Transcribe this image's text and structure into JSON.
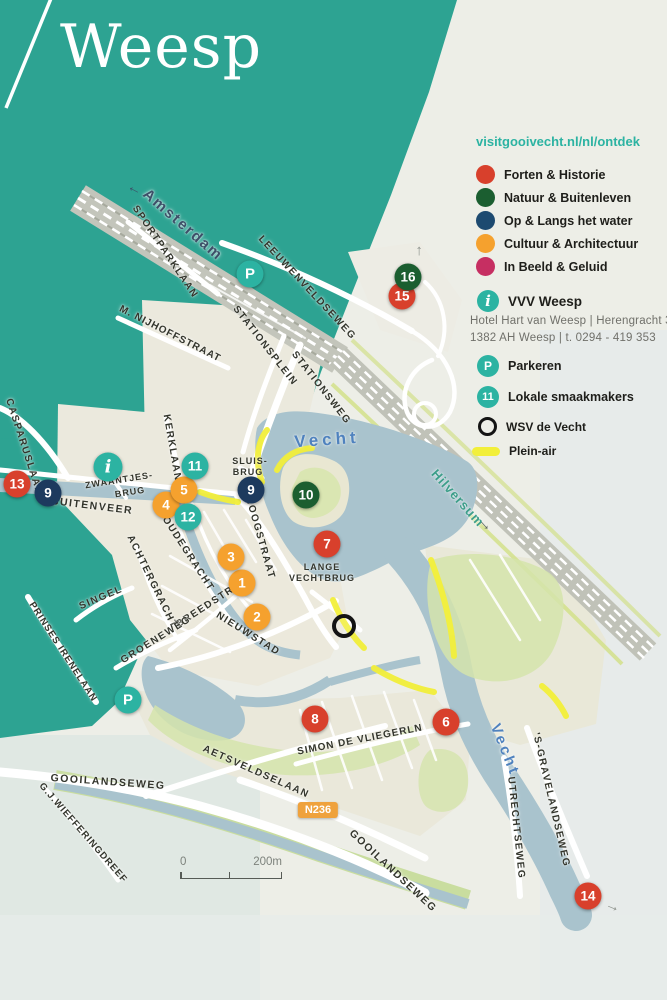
{
  "header": {
    "title": "Weesp"
  },
  "legend": {
    "url": "visitgooivecht.nl/nl/ontdek",
    "categories": [
      {
        "label": "Forten & Historie",
        "color": "#d8402c"
      },
      {
        "label": "Natuur & Buitenleven",
        "color": "#1b5e30"
      },
      {
        "label": "Op & Langs het water",
        "color": "#1d4a70"
      },
      {
        "label": "Cultuur & Architectuur",
        "color": "#f5a12e"
      },
      {
        "label": "In Beeld & Geluid",
        "color": "#c62f62"
      }
    ],
    "vvv": {
      "icon": "i",
      "name": "VVV Weesp",
      "address_line1": "Hotel Hart van Weesp | Herengracht 35 |",
      "address_line2": "1382 AH Weesp | t. 0294 - 419 353"
    },
    "parking": {
      "icon": "P",
      "label": "Parkeren"
    },
    "local": {
      "icon": "11",
      "label": "Lokale smaakmakers"
    },
    "wsv": {
      "label": "WSV de Vecht"
    },
    "plein_air": {
      "label": "Plein-air"
    }
  },
  "map": {
    "road_badge": "N236",
    "scale_bar": {
      "start": "0",
      "end": "200m"
    },
    "markers": [
      {
        "n": "1",
        "c": "orange",
        "x": 242,
        "y": 583
      },
      {
        "n": "2",
        "c": "orange",
        "x": 257,
        "y": 617
      },
      {
        "n": "3",
        "c": "orange",
        "x": 231,
        "y": 557
      },
      {
        "n": "4",
        "c": "orange",
        "x": 166,
        "y": 505
      },
      {
        "n": "5",
        "c": "orange",
        "x": 184,
        "y": 490
      },
      {
        "n": "6",
        "c": "red",
        "x": 446,
        "y": 722
      },
      {
        "n": "7",
        "c": "red",
        "x": 327,
        "y": 544
      },
      {
        "n": "8",
        "c": "red",
        "x": 315,
        "y": 719
      },
      {
        "n": "9",
        "c": "navy",
        "x": 48,
        "y": 493
      },
      {
        "n": "9",
        "c": "navy",
        "x": 251,
        "y": 490
      },
      {
        "n": "10",
        "c": "green",
        "x": 306,
        "y": 495
      },
      {
        "n": "11",
        "c": "teal",
        "x": 195,
        "y": 466
      },
      {
        "n": "12",
        "c": "teal",
        "x": 188,
        "y": 517
      },
      {
        "n": "13",
        "c": "red",
        "x": 17,
        "y": 484
      },
      {
        "n": "14",
        "c": "red",
        "x": 588,
        "y": 896
      },
      {
        "n": "15",
        "c": "red",
        "x": 402,
        "y": 296
      },
      {
        "n": "16",
        "c": "green",
        "x": 408,
        "y": 277
      },
      {
        "n": "i",
        "c": "teal",
        "x": 108,
        "y": 467,
        "k": "info"
      },
      {
        "n": "P",
        "c": "teal",
        "x": 250,
        "y": 274,
        "k": "parking"
      },
      {
        "n": "P",
        "c": "teal",
        "x": 128,
        "y": 700,
        "k": "parking"
      },
      {
        "n": "",
        "c": "ring",
        "x": 344,
        "y": 626,
        "k": "wsv"
      }
    ],
    "labels": [
      {
        "t": "Amsterdam",
        "x": 183,
        "y": 225,
        "r": 41,
        "s": 15,
        "ls": 2,
        "c": "ams"
      },
      {
        "t": "SPORTPARKLAAN",
        "x": 165,
        "y": 252,
        "r": 56,
        "s": 10,
        "ls": 1.5,
        "c": "st"
      },
      {
        "t": "LEEUWENVELDSEWEG",
        "x": 307,
        "y": 288,
        "r": 47,
        "s": 10,
        "ls": 1.5,
        "c": "st"
      },
      {
        "t": "M. NIJHOFFSTRAAT",
        "x": 170,
        "y": 334,
        "r": 27,
        "s": 10,
        "ls": 1,
        "c": "st"
      },
      {
        "t": "STATIONSPLEIN",
        "x": 265,
        "y": 346,
        "r": 52,
        "s": 10,
        "ls": 1.5,
        "c": "st"
      },
      {
        "t": "STATIONSWEG",
        "x": 321,
        "y": 388,
        "r": 52,
        "s": 10,
        "ls": 1.5,
        "c": "st"
      },
      {
        "t": "KERKLAAN",
        "x": 172,
        "y": 448,
        "r": 80,
        "s": 10,
        "ls": 1.5,
        "c": "st"
      },
      {
        "t": "CASPARUSLAAN",
        "x": 24,
        "y": 447,
        "r": 72,
        "s": 10,
        "ls": 1.5,
        "c": "st"
      },
      {
        "t": "ZWAANTJES-",
        "x": 119,
        "y": 480,
        "r": -9,
        "s": 9,
        "ls": 1,
        "c": "st"
      },
      {
        "t": "BRUG",
        "x": 130,
        "y": 492,
        "r": -9,
        "s": 9,
        "ls": 1,
        "c": "st"
      },
      {
        "t": "BUITENVEER",
        "x": 92,
        "y": 506,
        "r": 7,
        "s": 10.5,
        "ls": 1.5,
        "c": "st"
      },
      {
        "t": "SLUIS-",
        "x": 250,
        "y": 461,
        "r": 0,
        "s": 9,
        "ls": 1,
        "c": "st"
      },
      {
        "t": "BRUG",
        "x": 248,
        "y": 472,
        "r": 0,
        "s": 9,
        "ls": 1,
        "c": "st"
      },
      {
        "t": "HOOGSTRAAT",
        "x": 260,
        "y": 538,
        "r": 74,
        "s": 10,
        "ls": 1.5,
        "c": "st"
      },
      {
        "t": "OUDEGRACHT",
        "x": 188,
        "y": 554,
        "r": 57,
        "s": 10,
        "ls": 1.5,
        "c": "st"
      },
      {
        "t": "ACHTERGRACHT",
        "x": 152,
        "y": 582,
        "r": 64,
        "s": 10,
        "ls": 1.5,
        "c": "st"
      },
      {
        "t": "BREEDSTR.",
        "x": 207,
        "y": 606,
        "r": -33,
        "s": 10,
        "ls": 1.5,
        "c": "st"
      },
      {
        "t": "NIEUWSTAD",
        "x": 248,
        "y": 634,
        "r": 32,
        "s": 10,
        "ls": 1.5,
        "c": "st"
      },
      {
        "t": "GROENEWEG",
        "x": 156,
        "y": 640,
        "r": -32,
        "s": 10,
        "ls": 1.5,
        "c": "st"
      },
      {
        "t": "SINGEL",
        "x": 101,
        "y": 598,
        "r": -23,
        "s": 10,
        "ls": 1.5,
        "c": "st"
      },
      {
        "t": "PRINSES IRENELAAN",
        "x": 63,
        "y": 652,
        "r": 57,
        "s": 9.5,
        "ls": 1,
        "c": "st"
      },
      {
        "t": "LANGE",
        "x": 322,
        "y": 567,
        "r": 0,
        "s": 9,
        "ls": 1,
        "c": "st"
      },
      {
        "t": "VECHTBRUG",
        "x": 322,
        "y": 578,
        "r": 0,
        "s": 9,
        "ls": 1,
        "c": "st"
      },
      {
        "t": "AETSVELDSELAAN",
        "x": 256,
        "y": 772,
        "r": 24,
        "s": 10,
        "ls": 1.5,
        "c": "st"
      },
      {
        "t": "SIMON DE VLIEGERLN",
        "x": 360,
        "y": 740,
        "r": -11,
        "s": 10,
        "ls": 1,
        "c": "st"
      },
      {
        "t": "GOOILANDSEWEG",
        "x": 108,
        "y": 782,
        "r": 4,
        "s": 10.5,
        "ls": 1.5,
        "c": "st"
      },
      {
        "t": "G.J.WIEFFERINGDREEF",
        "x": 83,
        "y": 833,
        "r": 49,
        "s": 9.5,
        "ls": 1,
        "c": "st"
      },
      {
        "t": "GOOILANDSEWEG",
        "x": 393,
        "y": 871,
        "r": 43,
        "s": 10.5,
        "ls": 1.5,
        "c": "st"
      },
      {
        "t": "UTRECHTSEWEG",
        "x": 516,
        "y": 828,
        "r": 84,
        "s": 10,
        "ls": 1.5,
        "c": "st"
      },
      {
        "t": "'S-GRAVELANDSEWEG",
        "x": 551,
        "y": 800,
        "r": 77,
        "s": 10,
        "ls": 1.5,
        "c": "st"
      },
      {
        "t": "Vecht",
        "x": 327,
        "y": 440,
        "r": -4,
        "s": 17,
        "ls": 4,
        "c": "rv"
      },
      {
        "t": "Vecht",
        "x": 505,
        "y": 750,
        "r": 68,
        "s": 15,
        "ls": 3,
        "c": "rv"
      },
      {
        "t": "Hilversum",
        "x": 458,
        "y": 498,
        "r": 48,
        "s": 13,
        "ls": 1,
        "c": "hv"
      }
    ],
    "arrows": [
      {
        "g": "→",
        "x": 133,
        "y": 192,
        "r": -152,
        "hx": "#3d4f68"
      },
      {
        "g": "→",
        "x": 417,
        "y": 251,
        "r": -90,
        "hx": "#8e938d"
      },
      {
        "g": "→",
        "x": 486,
        "y": 524,
        "r": 48,
        "hx": "#55605a"
      },
      {
        "g": "→",
        "x": 613,
        "y": 906,
        "r": 22,
        "hx": "#8e938d"
      }
    ]
  },
  "colors": {
    "brand_teal": "#2da392",
    "water": "#a9c3cd",
    "plein_air_yellow": "#f2ef3a",
    "marker_red": "#d8402c",
    "marker_green": "#1b5e30",
    "marker_navy": "#1d3a5e",
    "marker_orange": "#f5a12e",
    "marker_teal": "#2cb3a2"
  }
}
